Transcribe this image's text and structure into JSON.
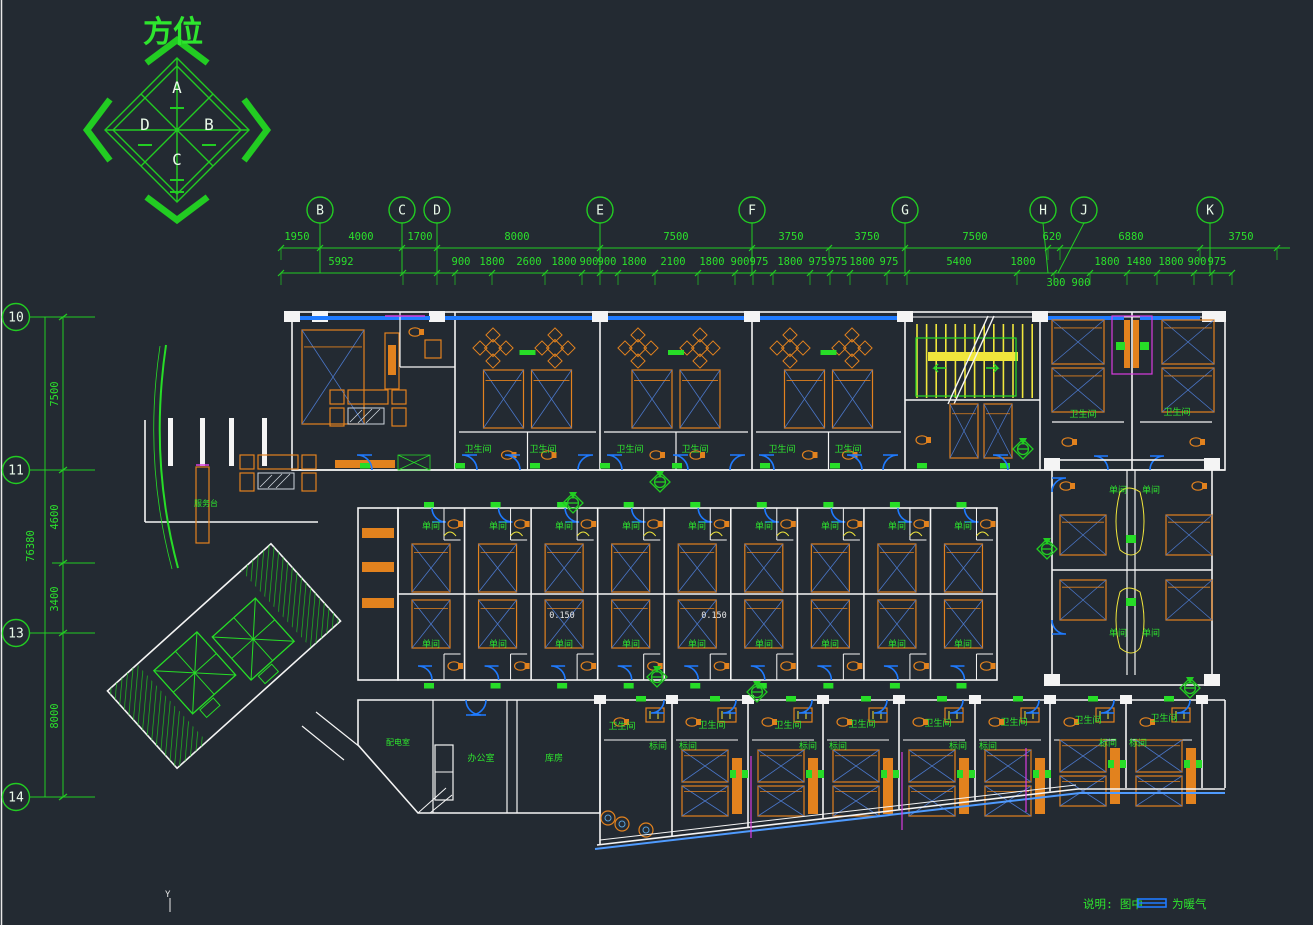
{
  "colors": {
    "background": "#232a32",
    "grid_green": "#22cc22",
    "text_green": "#2ee62e",
    "wall_white": "#f4f4f4",
    "window_blue": "#1f7bff",
    "slope_blue": "#4f9bff",
    "furniture_orange": "#e2821e",
    "bed_diag_blue": "#4a76c8",
    "stair_yellow": "#f0e63c",
    "magenta": "#d93ce0"
  },
  "compass": {
    "title": "方位",
    "points": [
      {
        "t": "A",
        "x": 177,
        "y": 93
      },
      {
        "t": "B",
        "x": 209,
        "y": 130
      },
      {
        "t": "C",
        "x": 177,
        "y": 165
      },
      {
        "t": "D",
        "x": 145,
        "y": 130
      }
    ]
  },
  "grid_top": {
    "bubbles": [
      {
        "t": "B",
        "x": 320
      },
      {
        "t": "C",
        "x": 402
      },
      {
        "t": "D",
        "x": 437
      },
      {
        "t": "E",
        "x": 600
      },
      {
        "t": "F",
        "x": 752
      },
      {
        "t": "G",
        "x": 905
      },
      {
        "t": "H",
        "x": 1043,
        "tick": 1048
      },
      {
        "t": "J",
        "x": 1084,
        "tick": 1058
      },
      {
        "t": "K",
        "x": 1210
      }
    ]
  },
  "grid_left": {
    "bubbles": [
      {
        "t": "10",
        "y": 317
      },
      {
        "t": "11",
        "y": 470
      },
      {
        "t": "13",
        "y": 633
      },
      {
        "t": "14",
        "y": 797
      }
    ],
    "overall": {
      "t": "76380",
      "x": 34,
      "y": 546
    },
    "dims": [
      {
        "t": "7500",
        "x": 58,
        "y": 394
      },
      {
        "t": "4600",
        "x": 58,
        "y": 517
      },
      {
        "t": "3400",
        "x": 58,
        "y": 599
      },
      {
        "t": "8000",
        "x": 58,
        "y": 716
      }
    ]
  },
  "dims_top": {
    "row1": {
      "y": 240,
      "line": 248,
      "items": [
        {
          "t": "1950",
          "x": 297
        },
        {
          "t": "4000",
          "x": 361
        },
        {
          "t": "1700",
          "x": 420
        },
        {
          "t": "8000",
          "x": 517
        },
        {
          "t": "7500",
          "x": 676
        },
        {
          "t": "3750",
          "x": 791
        },
        {
          "t": "3750",
          "x": 867
        },
        {
          "t": "7500",
          "x": 975
        },
        {
          "t": "620",
          "x": 1052
        },
        {
          "t": "6880",
          "x": 1131
        },
        {
          "t": "3750",
          "x": 1241
        }
      ],
      "ticks": [
        281,
        320,
        402,
        437,
        600,
        752,
        829,
        905,
        1048,
        1060,
        1200,
        1277
      ]
    },
    "row2": {
      "y": 265,
      "line": 273,
      "items": [
        {
          "t": "5992",
          "x": 341
        },
        {
          "t": "900",
          "x": 461
        },
        {
          "t": "1800",
          "x": 492
        },
        {
          "t": "2600",
          "x": 529
        },
        {
          "t": "1800",
          "x": 564
        },
        {
          "t": "900",
          "x": 589
        },
        {
          "t": "900",
          "x": 607
        },
        {
          "t": "1800",
          "x": 634
        },
        {
          "t": "2100",
          "x": 673
        },
        {
          "t": "1800",
          "x": 712
        },
        {
          "t": "900",
          "x": 740
        },
        {
          "t": "975",
          "x": 759
        },
        {
          "t": "1800",
          "x": 790
        },
        {
          "t": "975",
          "x": 818
        },
        {
          "t": "975",
          "x": 838
        },
        {
          "t": "1800",
          "x": 862
        },
        {
          "t": "975",
          "x": 889
        },
        {
          "t": "5400",
          "x": 959
        },
        {
          "t": "1800",
          "x": 1023
        },
        {
          "t": "1800",
          "x": 1107
        },
        {
          "t": "1480",
          "x": 1139
        },
        {
          "t": "1800",
          "x": 1171
        },
        {
          "t": "900",
          "x": 1197
        },
        {
          "t": "975",
          "x": 1217
        }
      ],
      "ticks": [
        281,
        403,
        437,
        455,
        492,
        545,
        582,
        600,
        618,
        655,
        698,
        735,
        753,
        773,
        810,
        830,
        850,
        887,
        907,
        1017,
        1054,
        1090,
        1127,
        1157,
        1194,
        1212,
        1232
      ]
    },
    "row3": {
      "y": 286,
      "items": [
        {
          "t": "300",
          "x": 1056
        },
        {
          "t": "900",
          "x": 1081
        }
      ]
    }
  },
  "plan_labels": [
    {
      "t": "卫生间",
      "x": 478,
      "y": 452
    },
    {
      "t": "卫生间",
      "x": 543,
      "y": 452
    },
    {
      "t": "卫生间",
      "x": 630,
      "y": 452
    },
    {
      "t": "卫生间",
      "x": 695,
      "y": 452
    },
    {
      "t": "卫生间",
      "x": 782,
      "y": 452
    },
    {
      "t": "卫生间",
      "x": 848,
      "y": 452
    },
    {
      "t": "卫生间",
      "x": 1083,
      "y": 417
    },
    {
      "t": "卫生间",
      "x": 1177,
      "y": 415
    },
    {
      "t": "单间",
      "x": 431,
      "y": 529
    },
    {
      "t": "单间",
      "x": 498,
      "y": 529
    },
    {
      "t": "单间",
      "x": 564,
      "y": 529
    },
    {
      "t": "单间",
      "x": 631,
      "y": 529
    },
    {
      "t": "单间",
      "x": 697,
      "y": 529
    },
    {
      "t": "单间",
      "x": 764,
      "y": 529
    },
    {
      "t": "单间",
      "x": 830,
      "y": 529
    },
    {
      "t": "单间",
      "x": 897,
      "y": 529
    },
    {
      "t": "单间",
      "x": 963,
      "y": 529
    },
    {
      "t": "单间",
      "x": 431,
      "y": 647
    },
    {
      "t": "单间",
      "x": 498,
      "y": 647
    },
    {
      "t": "单间",
      "x": 564,
      "y": 647
    },
    {
      "t": "单间",
      "x": 631,
      "y": 647
    },
    {
      "t": "单间",
      "x": 697,
      "y": 647
    },
    {
      "t": "单间",
      "x": 764,
      "y": 647
    },
    {
      "t": "单间",
      "x": 830,
      "y": 647
    },
    {
      "t": "单间",
      "x": 897,
      "y": 647
    },
    {
      "t": "单间",
      "x": 963,
      "y": 647
    },
    {
      "t": "单间",
      "x": 1118,
      "y": 493
    },
    {
      "t": "单间",
      "x": 1151,
      "y": 493
    },
    {
      "t": "单间",
      "x": 1118,
      "y": 636
    },
    {
      "t": "单间",
      "x": 1151,
      "y": 636
    },
    {
      "t": "标间",
      "x": 658,
      "y": 749
    },
    {
      "t": "标间",
      "x": 688,
      "y": 749
    },
    {
      "t": "标间",
      "x": 808,
      "y": 749
    },
    {
      "t": "标间",
      "x": 838,
      "y": 749
    },
    {
      "t": "标间",
      "x": 958,
      "y": 749
    },
    {
      "t": "标间",
      "x": 988,
      "y": 749
    },
    {
      "t": "标间",
      "x": 1108,
      "y": 746
    },
    {
      "t": "标间",
      "x": 1138,
      "y": 746
    },
    {
      "t": "卫生间",
      "x": 622,
      "y": 729
    },
    {
      "t": "卫生间",
      "x": 712,
      "y": 728
    },
    {
      "t": "卫生间",
      "x": 788,
      "y": 728
    },
    {
      "t": "卫生间",
      "x": 862,
      "y": 727
    },
    {
      "t": "卫生间",
      "x": 938,
      "y": 726
    },
    {
      "t": "卫生间",
      "x": 1014,
      "y": 725
    },
    {
      "t": "卫生间",
      "x": 1088,
      "y": 723
    },
    {
      "t": "卫生间",
      "x": 1164,
      "y": 721
    },
    {
      "t": "服务台",
      "x": 206,
      "y": 506,
      "s": 8
    },
    {
      "t": "配电室",
      "x": 398,
      "y": 745,
      "s": 8
    },
    {
      "t": "办公室",
      "x": 481,
      "y": 761
    },
    {
      "t": "库房",
      "x": 554,
      "y": 761
    },
    {
      "t": "0.150",
      "x": 562,
      "y": 618,
      "c": "#e8e8e8",
      "s": 8.5
    },
    {
      "t": "0.150",
      "x": 714,
      "y": 618,
      "c": "#e8e8e8",
      "s": 8.5
    }
  ],
  "legend": {
    "note": "说明: 图中",
    "suffix": "为暖气"
  },
  "ucs_marker": {
    "t": "Y"
  }
}
